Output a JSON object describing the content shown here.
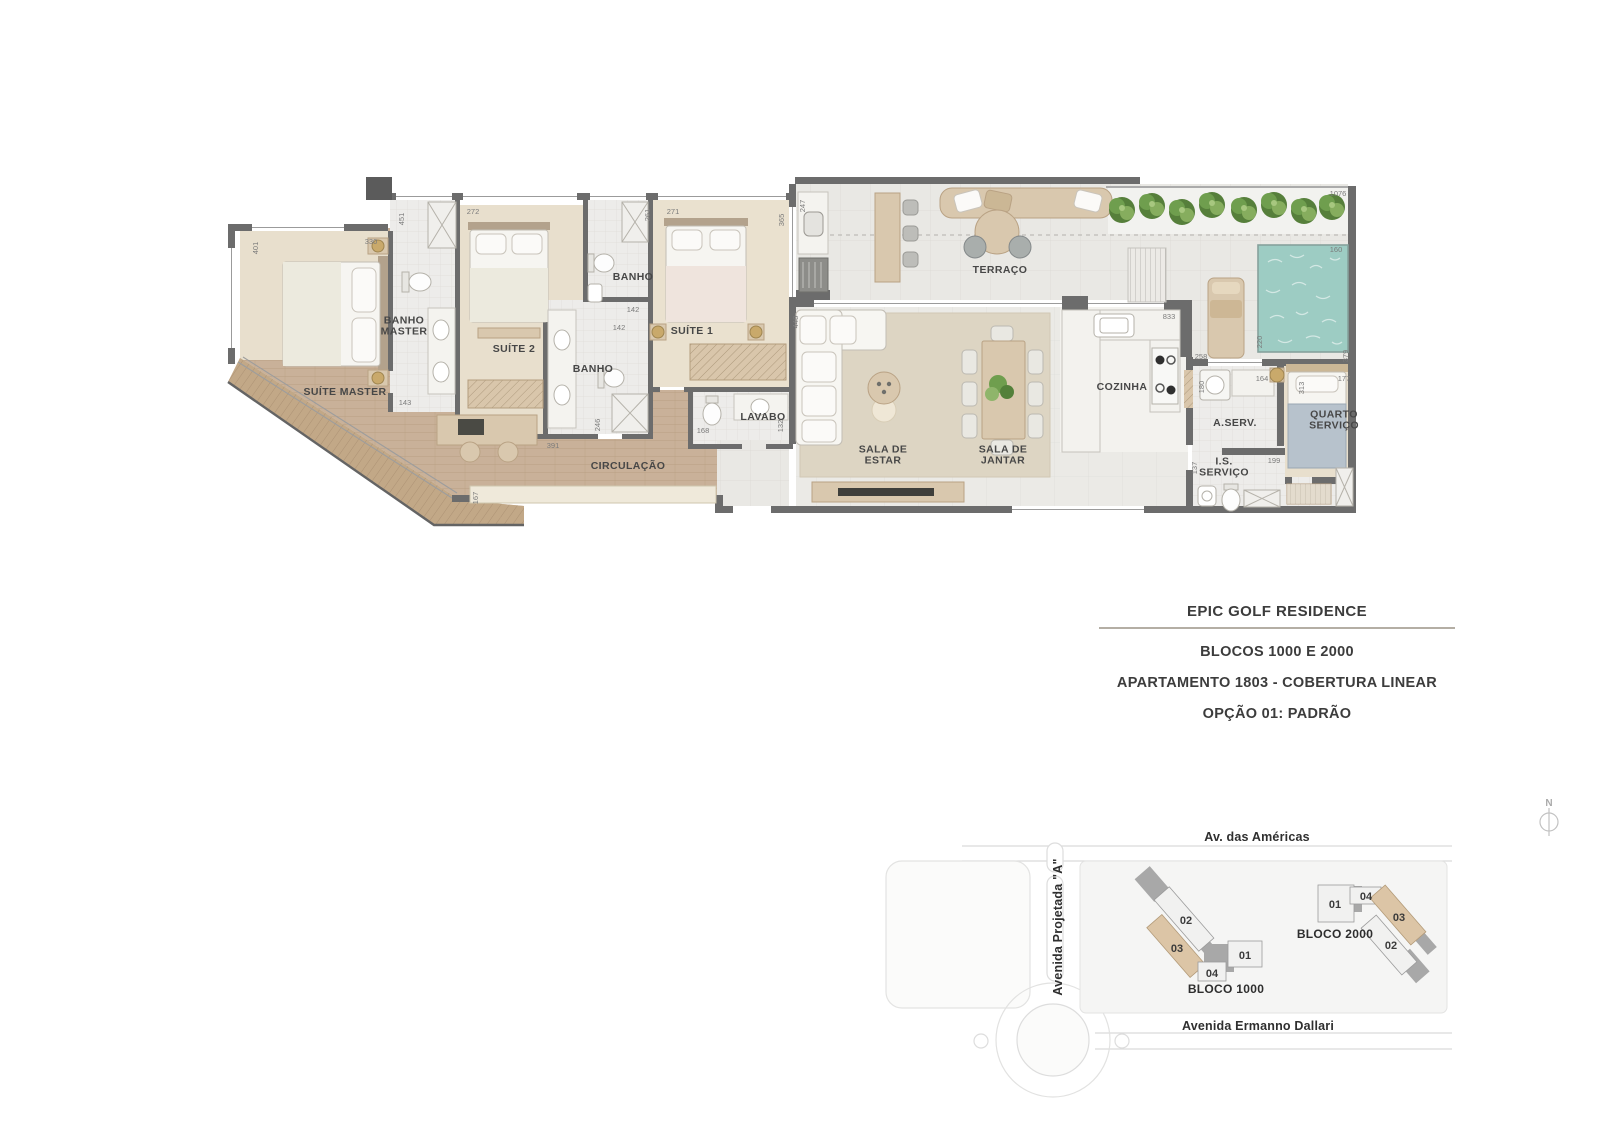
{
  "title_block": {
    "line1": "EPIC GOLF RESIDENCE",
    "line2": "BLOCOS 1000 E 2000",
    "line3": "APARTAMENTO 1803 - COBERTURA LINEAR",
    "line4": "OPÇÃO 01: PADRÃO"
  },
  "north_label": "N",
  "colors": {
    "wall": "#6c6c6c",
    "wood_floor": "#c9b199",
    "highlight_unit": "#dcc5a6",
    "pool_water": "#9dccc3",
    "planter_green": "#6f9e4e"
  },
  "plan": {
    "room_labels": [
      {
        "name": "room-label-suite-master",
        "lines": [
          "SUÍTE MASTER"
        ],
        "x": 345,
        "y": 395
      },
      {
        "name": "room-label-banho-master",
        "lines": [
          "BANHO",
          "MASTER"
        ],
        "x": 404,
        "y": 329
      },
      {
        "name": "room-label-suite-2",
        "lines": [
          "SUÍTE 2"
        ],
        "x": 514,
        "y": 352
      },
      {
        "name": "room-label-banho-1",
        "lines": [
          "BANHO"
        ],
        "x": 633,
        "y": 280
      },
      {
        "name": "room-label-banho-2",
        "lines": [
          "BANHO"
        ],
        "x": 593,
        "y": 372
      },
      {
        "name": "room-label-suite-1",
        "lines": [
          "SUÍTE 1"
        ],
        "x": 692,
        "y": 334
      },
      {
        "name": "room-label-lavabo",
        "lines": [
          "LAVABO"
        ],
        "x": 763,
        "y": 420
      },
      {
        "name": "room-label-circulacao",
        "lines": [
          "CIRCULAÇÃO"
        ],
        "x": 628,
        "y": 469
      },
      {
        "name": "room-label-terraco",
        "lines": [
          "TERRAÇO"
        ],
        "x": 1000,
        "y": 273
      },
      {
        "name": "room-label-sala-de-estar",
        "lines": [
          "SALA DE",
          "ESTAR"
        ],
        "x": 883,
        "y": 458
      },
      {
        "name": "room-label-sala-de-jantar",
        "lines": [
          "SALA DE",
          "JANTAR"
        ],
        "x": 1003,
        "y": 458
      },
      {
        "name": "room-label-cozinha",
        "lines": [
          "COZINHA"
        ],
        "x": 1122,
        "y": 390
      },
      {
        "name": "room-label-a-serv",
        "lines": [
          "A.SERV."
        ],
        "x": 1235,
        "y": 426
      },
      {
        "name": "room-label-is-servico",
        "lines": [
          "I.S.",
          "SERVIÇO"
        ],
        "x": 1224,
        "y": 470
      },
      {
        "name": "room-label-quarto-servico",
        "lines": [
          "QUARTO",
          "SERVIÇO"
        ],
        "x": 1334,
        "y": 423
      }
    ],
    "dim_labels": [
      {
        "v": "401",
        "x": 258,
        "y": 248,
        "rot": true
      },
      {
        "v": "330",
        "x": 371,
        "y": 244,
        "rot": false
      },
      {
        "v": "451",
        "x": 404,
        "y": 219,
        "rot": true
      },
      {
        "v": "143",
        "x": 405,
        "y": 405,
        "rot": false
      },
      {
        "v": "272",
        "x": 473,
        "y": 214,
        "rot": false
      },
      {
        "v": "261",
        "x": 650,
        "y": 215,
        "rot": true
      },
      {
        "v": "142",
        "x": 633,
        "y": 312,
        "rot": false
      },
      {
        "v": "142",
        "x": 619,
        "y": 330,
        "rot": false
      },
      {
        "v": "271",
        "x": 673,
        "y": 214,
        "rot": false
      },
      {
        "v": "365",
        "x": 784,
        "y": 220,
        "rot": true
      },
      {
        "v": "246",
        "x": 600,
        "y": 425,
        "rot": true
      },
      {
        "v": "168",
        "x": 703,
        "y": 433,
        "rot": false
      },
      {
        "v": "132",
        "x": 783,
        "y": 426,
        "rot": true
      },
      {
        "v": "391",
        "x": 553,
        "y": 448,
        "rot": false
      },
      {
        "v": "167",
        "x": 478,
        "y": 498,
        "rot": true
      },
      {
        "v": "247",
        "x": 805,
        "y": 206,
        "rot": true
      },
      {
        "v": "448",
        "x": 798,
        "y": 322,
        "rot": true
      },
      {
        "v": "833",
        "x": 1169,
        "y": 319,
        "rot": false
      },
      {
        "v": "258",
        "x": 1201,
        "y": 359,
        "rot": false
      },
      {
        "v": "180",
        "x": 1204,
        "y": 387,
        "rot": true
      },
      {
        "v": "164",
        "x": 1262,
        "y": 381,
        "rot": false
      },
      {
        "v": "313",
        "x": 1304,
        "y": 388,
        "rot": true
      },
      {
        "v": "177",
        "x": 1344,
        "y": 381,
        "rot": false
      },
      {
        "v": "137",
        "x": 1197,
        "y": 468,
        "rot": true
      },
      {
        "v": "199",
        "x": 1274,
        "y": 463,
        "rot": false
      },
      {
        "v": "1076",
        "x": 1338,
        "y": 196,
        "rot": false
      },
      {
        "v": "160",
        "x": 1336,
        "y": 252,
        "rot": false
      },
      {
        "v": "220",
        "x": 1262,
        "y": 342,
        "rot": true
      },
      {
        "v": "379",
        "x": 1348,
        "y": 356,
        "rot": true
      }
    ]
  },
  "site_map": {
    "street_labels": [
      {
        "name": "street-av-das-americas",
        "text": "Av. das Américas",
        "x": 1257,
        "y": 841,
        "rot": false
      },
      {
        "name": "street-avenida-projetada-a",
        "text": "Avenida Projetada \"A\"",
        "x": 1062,
        "y": 927,
        "rot": true
      },
      {
        "name": "street-avenida-ermanno-dallari",
        "text": "Avenida Ermanno Dallari",
        "x": 1258,
        "y": 1030,
        "rot": false
      }
    ],
    "bloco_labels": [
      {
        "name": "label-bloco-1000",
        "text": "BLOCO 1000",
        "x": 1226,
        "y": 993
      },
      {
        "name": "label-bloco-2000",
        "text": "BLOCO 2000",
        "x": 1335,
        "y": 938
      }
    ],
    "unit_labels": [
      {
        "name": "unit-1000-02",
        "text": "02",
        "x": 1186,
        "y": 924
      },
      {
        "name": "unit-1000-03",
        "text": "03",
        "x": 1177,
        "y": 952
      },
      {
        "name": "unit-1000-01",
        "text": "01",
        "x": 1245,
        "y": 959
      },
      {
        "name": "unit-1000-04",
        "text": "04",
        "x": 1212,
        "y": 977
      },
      {
        "name": "unit-2000-01",
        "text": "01",
        "x": 1335,
        "y": 908
      },
      {
        "name": "unit-2000-04",
        "text": "04",
        "x": 1366,
        "y": 900
      },
      {
        "name": "unit-2000-03",
        "text": "03",
        "x": 1399,
        "y": 921
      },
      {
        "name": "unit-2000-02",
        "text": "02",
        "x": 1391,
        "y": 949
      }
    ]
  }
}
